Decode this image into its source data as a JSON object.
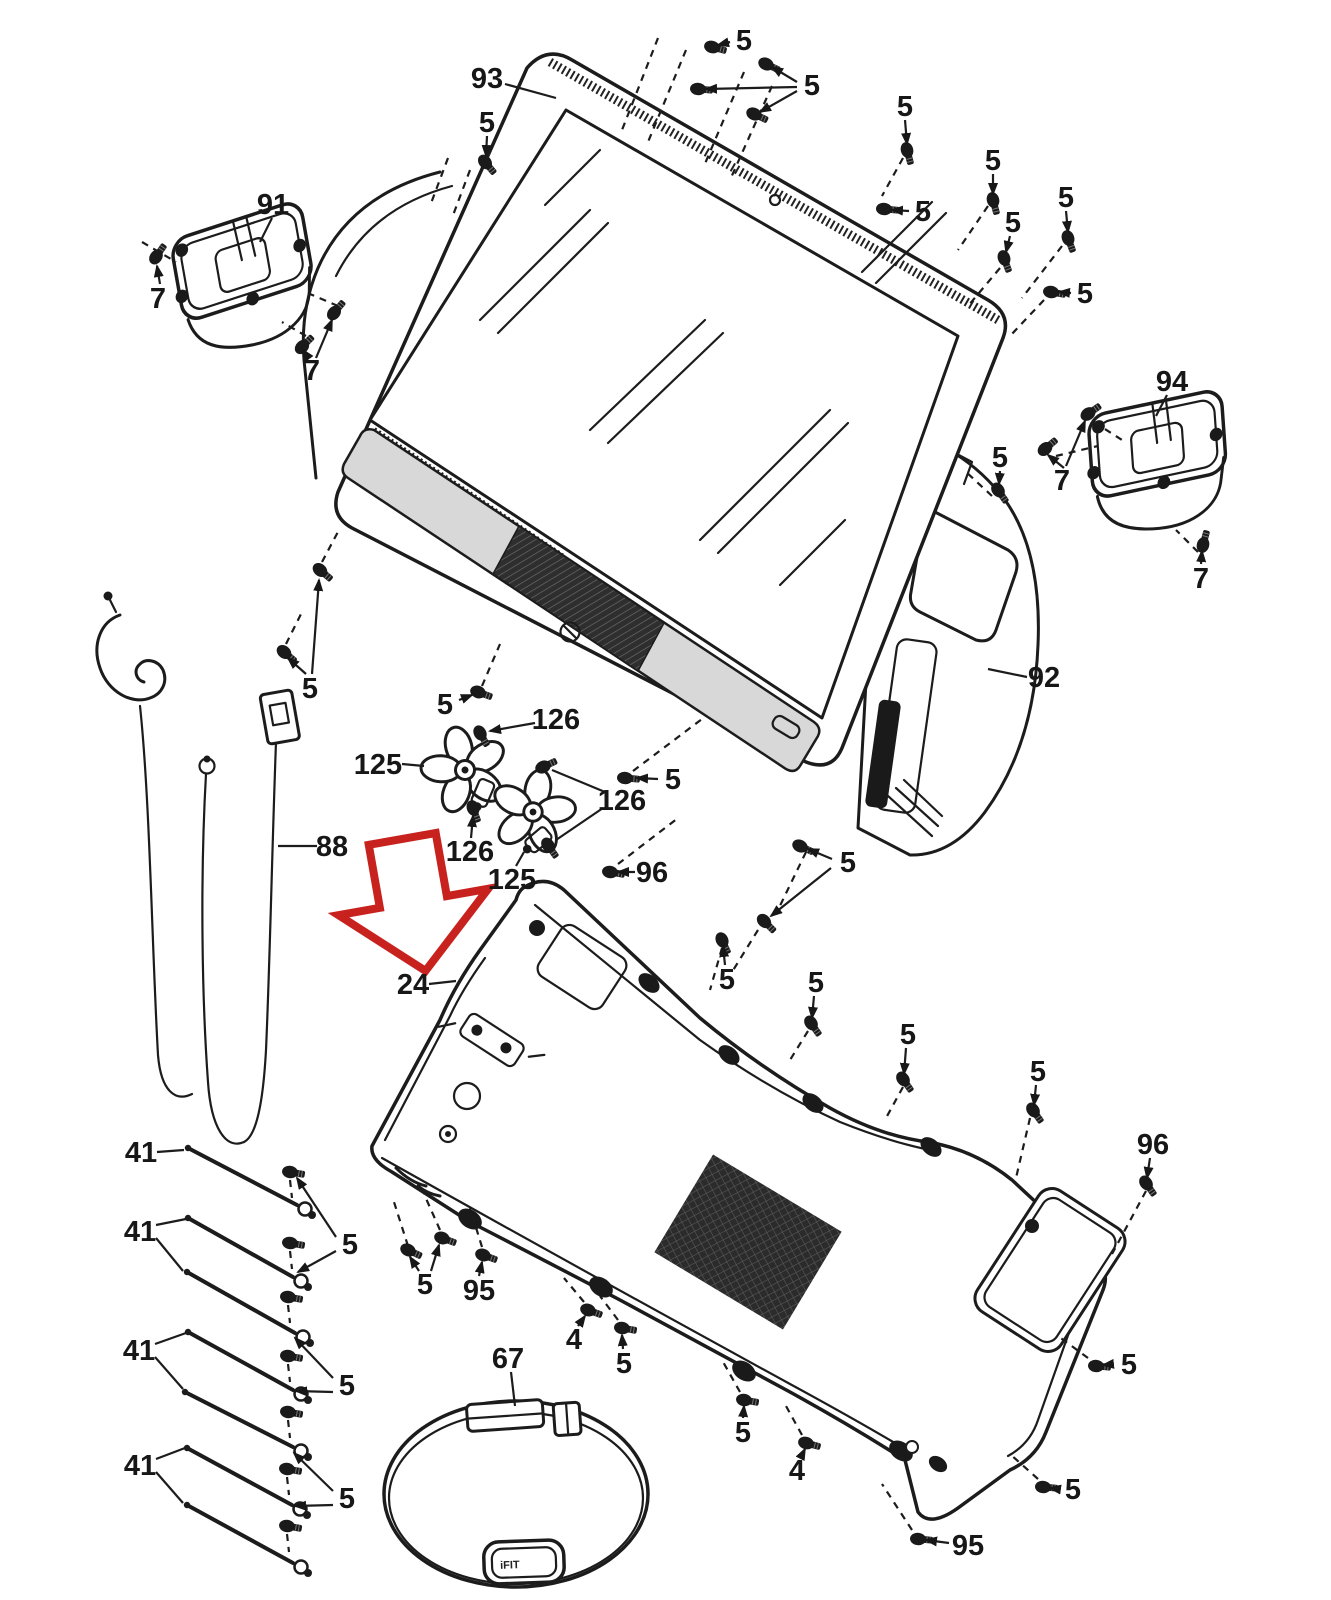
{
  "diagram": {
    "background": "#ffffff",
    "line_color": "#1c1c1c",
    "accent_red": "#c8221e",
    "trim_gray": "#d8d8d8",
    "grille_dark": "#2e2e2e",
    "module_label": "iFIT"
  },
  "labels": [
    {
      "t": "93",
      "x": 487,
      "y": 78,
      "a": 0,
      "l": [
        [
          505,
          84,
          556,
          98
        ]
      ]
    },
    {
      "t": "5",
      "x": 487,
      "y": 122,
      "a": 1,
      "l": [
        [
          487,
          136,
          486,
          156
        ]
      ]
    },
    {
      "t": "5",
      "x": 744,
      "y": 40,
      "a": 1,
      "l": [
        [
          730,
          42,
          718,
          45
        ]
      ]
    },
    {
      "t": "5",
      "x": 812,
      "y": 85,
      "a": 1,
      "l": [
        [
          797,
          82,
          772,
          67
        ],
        [
          797,
          87,
          706,
          89
        ],
        [
          797,
          91,
          760,
          112
        ]
      ]
    },
    {
      "t": "5",
      "x": 905,
      "y": 106,
      "a": 1,
      "l": [
        [
          905,
          120,
          907,
          144
        ]
      ]
    },
    {
      "t": "5",
      "x": 923,
      "y": 211,
      "a": 1,
      "l": [
        [
          909,
          211,
          892,
          210
        ]
      ]
    },
    {
      "t": "5",
      "x": 993,
      "y": 160,
      "a": 1,
      "l": [
        [
          993,
          174,
          993,
          194
        ]
      ]
    },
    {
      "t": "5",
      "x": 1013,
      "y": 222,
      "a": 1,
      "l": [
        [
          1010,
          236,
          1006,
          252
        ]
      ]
    },
    {
      "t": "5",
      "x": 1066,
      "y": 197,
      "a": 1,
      "l": [
        [
          1066,
          211,
          1068,
          232
        ]
      ]
    },
    {
      "t": "5",
      "x": 1085,
      "y": 293,
      "a": 1,
      "l": [
        [
          1071,
          293,
          1059,
          292
        ]
      ]
    },
    {
      "t": "5",
      "x": 1000,
      "y": 457,
      "a": 1,
      "l": [
        [
          1000,
          471,
          999,
          484
        ]
      ]
    },
    {
      "t": "91",
      "x": 273,
      "y": 204,
      "a": 0,
      "l": [
        [
          272,
          218,
          260,
          242
        ]
      ]
    },
    {
      "t": "7",
      "x": 158,
      "y": 298,
      "a": 1,
      "l": [
        [
          160,
          284,
          157,
          266
        ]
      ]
    },
    {
      "t": "7",
      "x": 312,
      "y": 370,
      "a": 1,
      "l": [
        [
          308,
          357,
          303,
          350
        ],
        [
          316,
          358,
          332,
          320
        ]
      ]
    },
    {
      "t": "94",
      "x": 1172,
      "y": 381,
      "a": 0,
      "l": [
        [
          1167,
          395,
          1156,
          416
        ]
      ]
    },
    {
      "t": "7",
      "x": 1062,
      "y": 480,
      "a": 1,
      "l": [
        [
          1066,
          466,
          1085,
          421
        ],
        [
          1064,
          468,
          1048,
          455
        ]
      ]
    },
    {
      "t": "7",
      "x": 1201,
      "y": 578,
      "a": 1,
      "l": [
        [
          1201,
          564,
          1202,
          551
        ]
      ]
    },
    {
      "t": "92",
      "x": 1044,
      "y": 677,
      "a": 0,
      "l": [
        [
          1027,
          677,
          988,
          669
        ]
      ]
    },
    {
      "t": "5",
      "x": 310,
      "y": 688,
      "a": 1,
      "l": [
        [
          306,
          674,
          288,
          658
        ],
        [
          312,
          674,
          319,
          580
        ]
      ]
    },
    {
      "t": "5",
      "x": 445,
      "y": 704,
      "a": 1,
      "l": [
        [
          459,
          700,
          472,
          695
        ]
      ]
    },
    {
      "t": "125",
      "x": 378,
      "y": 764,
      "a": 0,
      "l": [
        [
          402,
          764,
          424,
          766
        ]
      ]
    },
    {
      "t": "126",
      "x": 556,
      "y": 719,
      "a": 1,
      "l": [
        [
          535,
          723,
          490,
          731
        ]
      ]
    },
    {
      "t": "5",
      "x": 673,
      "y": 779,
      "a": 1,
      "l": [
        [
          658,
          779,
          637,
          778
        ]
      ]
    },
    {
      "t": "126",
      "x": 622,
      "y": 800,
      "a": 0,
      "l": [
        [
          605,
          792,
          552,
          770
        ],
        [
          603,
          808,
          556,
          840
        ]
      ]
    },
    {
      "t": "126",
      "x": 470,
      "y": 851,
      "a": 1,
      "l": [
        [
          471,
          838,
          473,
          816
        ]
      ]
    },
    {
      "t": "125",
      "x": 512,
      "y": 879,
      "a": 0,
      "l": [
        [
          516,
          866,
          524,
          852
        ]
      ]
    },
    {
      "t": "96",
      "x": 652,
      "y": 872,
      "a": 1,
      "l": [
        [
          635,
          872,
          618,
          872
        ]
      ]
    },
    {
      "t": "88",
      "x": 332,
      "y": 846,
      "a": 0,
      "l": [
        [
          317,
          846,
          278,
          846
        ]
      ]
    },
    {
      "t": "24",
      "x": 413,
      "y": 984,
      "a": 0,
      "l": [
        [
          429,
          984,
          456,
          981
        ]
      ]
    },
    {
      "t": "5",
      "x": 848,
      "y": 862,
      "a": 1,
      "l": [
        [
          832,
          859,
          808,
          849
        ],
        [
          831,
          868,
          771,
          916
        ]
      ]
    },
    {
      "t": "5",
      "x": 727,
      "y": 979,
      "a": 1,
      "l": [
        [
          725,
          965,
          723,
          946
        ]
      ]
    },
    {
      "t": "5",
      "x": 816,
      "y": 982,
      "a": 1,
      "l": [
        [
          814,
          996,
          812,
          1018
        ]
      ]
    },
    {
      "t": "5",
      "x": 908,
      "y": 1034,
      "a": 1,
      "l": [
        [
          906,
          1048,
          904,
          1074
        ]
      ]
    },
    {
      "t": "5",
      "x": 1038,
      "y": 1071,
      "a": 1,
      "l": [
        [
          1036,
          1085,
          1034,
          1105
        ]
      ]
    },
    {
      "t": "96",
      "x": 1153,
      "y": 1144,
      "a": 1,
      "l": [
        [
          1150,
          1158,
          1147,
          1178
        ]
      ]
    },
    {
      "t": "41",
      "x": 141,
      "y": 1152,
      "a": 0,
      "l": [
        [
          157,
          1152,
          184,
          1150
        ]
      ]
    },
    {
      "t": "41",
      "x": 140,
      "y": 1231,
      "a": 0,
      "l": [
        [
          156,
          1225,
          186,
          1219
        ],
        [
          156,
          1238,
          183,
          1271
        ]
      ]
    },
    {
      "t": "41",
      "x": 139,
      "y": 1350,
      "a": 0,
      "l": [
        [
          155,
          1344,
          186,
          1333
        ],
        [
          155,
          1357,
          183,
          1389
        ]
      ]
    },
    {
      "t": "41",
      "x": 140,
      "y": 1465,
      "a": 0,
      "l": [
        [
          156,
          1459,
          185,
          1448
        ],
        [
          156,
          1472,
          183,
          1503
        ]
      ]
    },
    {
      "t": "5",
      "x": 350,
      "y": 1244,
      "a": 1,
      "l": [
        [
          336,
          1237,
          297,
          1178
        ],
        [
          336,
          1251,
          298,
          1272
        ]
      ]
    },
    {
      "t": "5",
      "x": 347,
      "y": 1385,
      "a": 1,
      "l": [
        [
          333,
          1378,
          295,
          1338
        ],
        [
          333,
          1392,
          296,
          1391
        ]
      ]
    },
    {
      "t": "5",
      "x": 347,
      "y": 1498,
      "a": 1,
      "l": [
        [
          333,
          1491,
          294,
          1453
        ],
        [
          333,
          1505,
          295,
          1506
        ]
      ]
    },
    {
      "t": "5",
      "x": 425,
      "y": 1284,
      "a": 1,
      "l": [
        [
          419,
          1271,
          410,
          1257
        ],
        [
          431,
          1271,
          439,
          1245
        ]
      ]
    },
    {
      "t": "95",
      "x": 479,
      "y": 1290,
      "a": 1,
      "l": [
        [
          479,
          1276,
          482,
          1262
        ]
      ]
    },
    {
      "t": "4",
      "x": 574,
      "y": 1339,
      "a": 1,
      "l": [
        [
          578,
          1326,
          585,
          1316
        ]
      ]
    },
    {
      "t": "5",
      "x": 624,
      "y": 1363,
      "a": 1,
      "l": [
        [
          623,
          1349,
          622,
          1335
        ]
      ]
    },
    {
      "t": "67",
      "x": 508,
      "y": 1358,
      "a": 0,
      "l": [
        [
          511,
          1372,
          515,
          1406
        ]
      ]
    },
    {
      "t": "5",
      "x": 743,
      "y": 1432,
      "a": 1,
      "l": [
        [
          743,
          1418,
          744,
          1406
        ]
      ]
    },
    {
      "t": "4",
      "x": 797,
      "y": 1470,
      "a": 1,
      "l": [
        [
          801,
          1457,
          805,
          1449
        ]
      ]
    },
    {
      "t": "95",
      "x": 968,
      "y": 1545,
      "a": 1,
      "l": [
        [
          949,
          1543,
          926,
          1540
        ]
      ]
    },
    {
      "t": "5",
      "x": 1073,
      "y": 1489,
      "a": 1,
      "l": [
        [
          1057,
          1489,
          1050,
          1488
        ]
      ]
    },
    {
      "t": "5",
      "x": 1129,
      "y": 1364,
      "a": 1,
      "l": [
        [
          1113,
          1364,
          1103,
          1365
        ]
      ]
    }
  ],
  "screws": [
    [
      485,
      162,
      50
    ],
    [
      712,
      47,
      15
    ],
    [
      766,
      64,
      25
    ],
    [
      698,
      89,
      5
    ],
    [
      754,
      114,
      25
    ],
    [
      907,
      150,
      75
    ],
    [
      884,
      209,
      5
    ],
    [
      993,
      200,
      75
    ],
    [
      1004,
      258,
      70
    ],
    [
      1068,
      238,
      70
    ],
    [
      1051,
      292,
      10
    ],
    [
      998,
      490,
      55
    ],
    [
      156,
      257,
      -55
    ],
    [
      302,
      347,
      -45
    ],
    [
      334,
      313,
      -50
    ],
    [
      1088,
      414,
      -35
    ],
    [
      1045,
      449,
      -40
    ],
    [
      1203,
      545,
      -75
    ],
    [
      320,
      570,
      40
    ],
    [
      284,
      652,
      40
    ],
    [
      478,
      692,
      20
    ],
    [
      480,
      733,
      60
    ],
    [
      473,
      808,
      70
    ],
    [
      543,
      767,
      -25
    ],
    [
      548,
      845,
      55
    ],
    [
      625,
      778,
      5
    ],
    [
      610,
      872,
      10
    ],
    [
      800,
      846,
      25
    ],
    [
      764,
      921,
      45
    ],
    [
      722,
      940,
      65
    ],
    [
      811,
      1023,
      55
    ],
    [
      903,
      1079,
      55
    ],
    [
      1033,
      1110,
      55
    ],
    [
      1146,
      1183,
      55
    ],
    [
      290,
      1172,
      10
    ],
    [
      290,
      1243,
      10
    ],
    [
      288,
      1297,
      10
    ],
    [
      288,
      1356,
      10
    ],
    [
      288,
      1412,
      10
    ],
    [
      287,
      1469,
      10
    ],
    [
      287,
      1526,
      10
    ],
    [
      408,
      1250,
      25
    ],
    [
      442,
      1238,
      20
    ],
    [
      483,
      1255,
      20
    ],
    [
      588,
      1310,
      20
    ],
    [
      622,
      1328,
      10
    ],
    [
      744,
      1400,
      10
    ],
    [
      806,
      1443,
      15
    ],
    [
      918,
      1539,
      5
    ],
    [
      1043,
      1487,
      5
    ],
    [
      1096,
      1366,
      5
    ]
  ],
  "dashed_lines": [
    [
      658,
      38,
      622,
      130
    ],
    [
      686,
      50,
      648,
      142
    ],
    [
      744,
      72,
      704,
      166
    ],
    [
      772,
      86,
      730,
      180
    ],
    [
      903,
      158,
      882,
      196
    ],
    [
      988,
      206,
      958,
      250
    ],
    [
      1000,
      268,
      968,
      306
    ],
    [
      1062,
      246,
      1022,
      298
    ],
    [
      1044,
      300,
      1010,
      336
    ],
    [
      992,
      496,
      964,
      470
    ],
    [
      142,
      242,
      176,
      262
    ],
    [
      306,
      336,
      282,
      322
    ],
    [
      338,
      306,
      310,
      294
    ],
    [
      1094,
      422,
      1122,
      440
    ],
    [
      1056,
      456,
      1098,
      446
    ],
    [
      1198,
      552,
      1176,
      530
    ],
    [
      448,
      158,
      430,
      206
    ],
    [
      470,
      170,
      452,
      218
    ],
    [
      322,
      562,
      340,
      528
    ],
    [
      286,
      644,
      302,
      612
    ],
    [
      482,
      686,
      500,
      644
    ],
    [
      633,
      771,
      706,
      716
    ],
    [
      618,
      864,
      678,
      818
    ],
    [
      806,
      852,
      776,
      914
    ],
    [
      758,
      930,
      732,
      972
    ],
    [
      722,
      948,
      710,
      990
    ],
    [
      808,
      1031,
      790,
      1060
    ],
    [
      903,
      1087,
      886,
      1118
    ],
    [
      1030,
      1118,
      1016,
      1178
    ],
    [
      1146,
      1191,
      1112,
      1254
    ],
    [
      584,
      1302,
      564,
      1278
    ],
    [
      618,
      1320,
      600,
      1296
    ],
    [
      740,
      1392,
      722,
      1360
    ],
    [
      802,
      1435,
      786,
      1406
    ],
    [
      912,
      1530,
      882,
      1484
    ],
    [
      1038,
      1479,
      1010,
      1454
    ],
    [
      1088,
      1358,
      1058,
      1336
    ],
    [
      408,
      1246,
      394,
      1202
    ],
    [
      440,
      1230,
      424,
      1194
    ],
    [
      482,
      1247,
      470,
      1208
    ],
    [
      290,
      1180,
      292,
      1198
    ],
    [
      290,
      1251,
      292,
      1269
    ],
    [
      288,
      1305,
      290,
      1323
    ],
    [
      288,
      1364,
      290,
      1382
    ],
    [
      288,
      1420,
      290,
      1438
    ],
    [
      287,
      1477,
      289,
      1495
    ],
    [
      287,
      1534,
      289,
      1552
    ]
  ],
  "rods": [
    [
      188,
      1148,
      297,
      1205
    ],
    [
      188,
      1218,
      293,
      1277
    ],
    [
      187,
      1272,
      295,
      1333
    ],
    [
      188,
      1332,
      293,
      1390
    ],
    [
      185,
      1392,
      293,
      1447
    ],
    [
      187,
      1448,
      292,
      1505
    ],
    [
      187,
      1505,
      293,
      1563
    ]
  ]
}
